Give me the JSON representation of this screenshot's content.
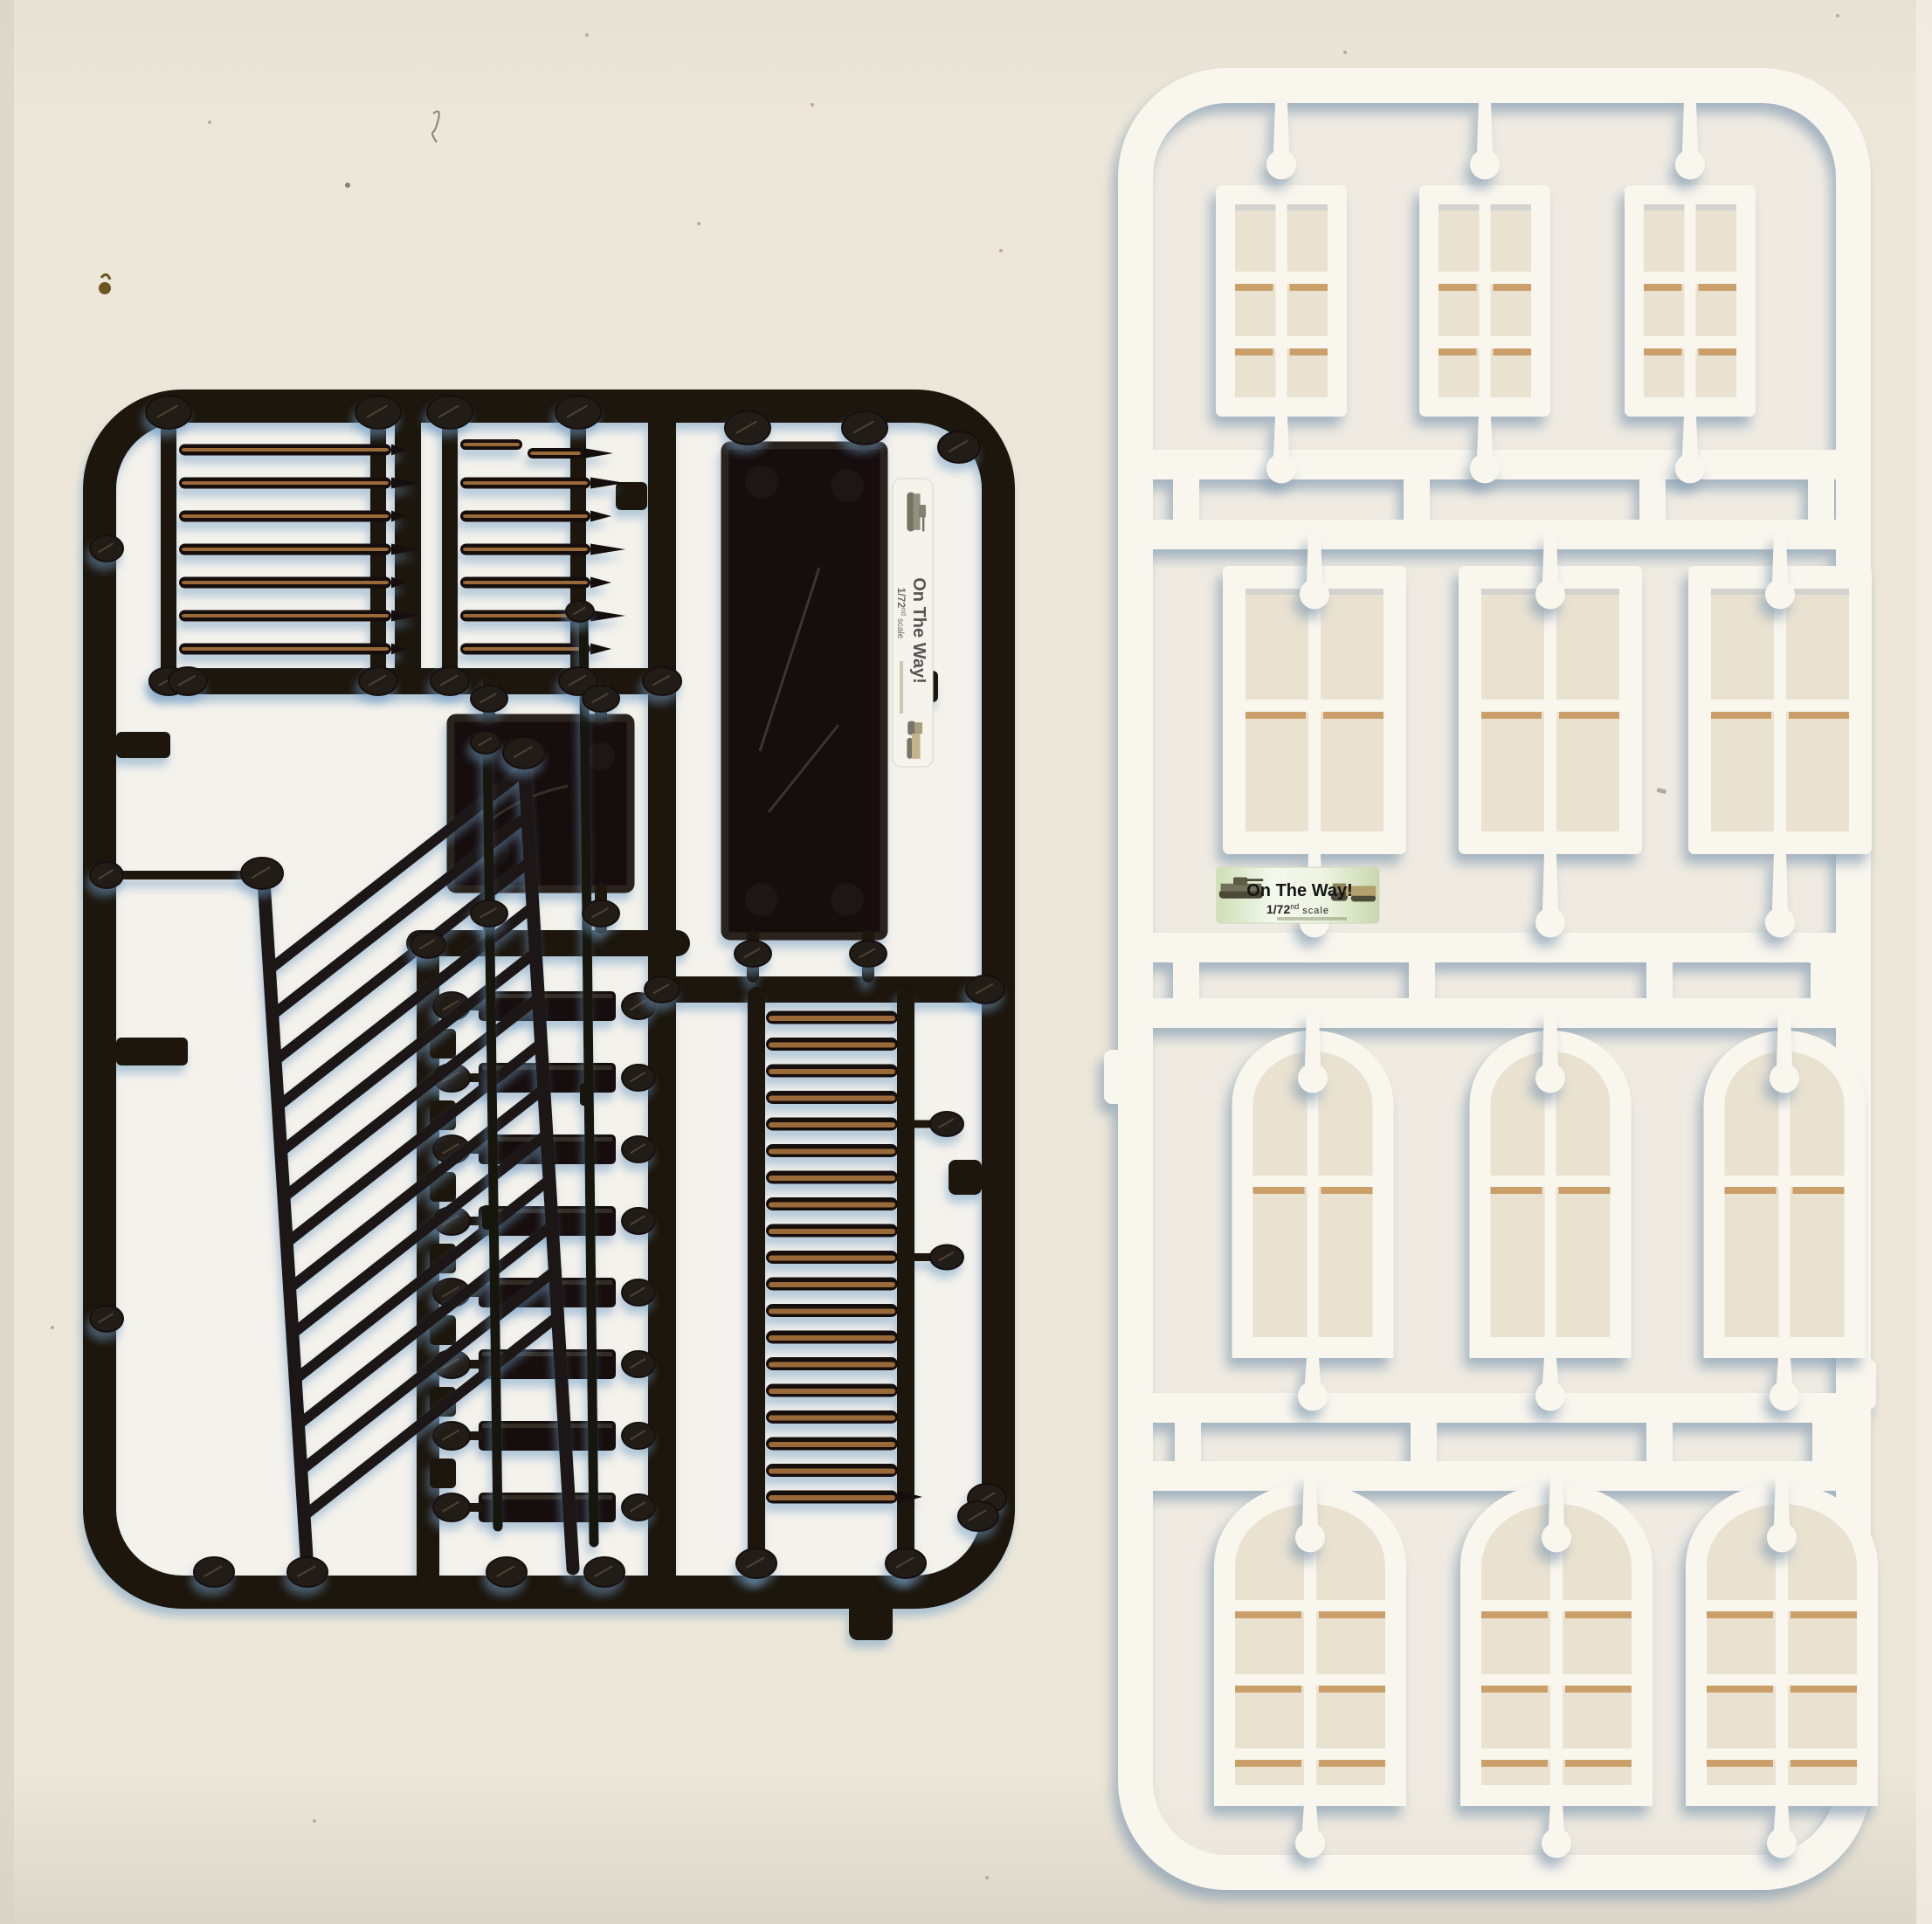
{
  "scene": {
    "description": "Flatbed scan of two injection-molded model kit sprues on a cream scanner bed",
    "background_hex": "#ebe5d7",
    "inner_backing_hex": "#f4f2ec"
  },
  "labels": {
    "brand": "On The Way!",
    "scale_num": "1/72",
    "scale_sup": "nd",
    "scale_word": "scale"
  },
  "black_sprue": {
    "name": "black detail sprue",
    "color_hex": "#1a1410",
    "parts": {
      "handrail_a_rungs": 7,
      "handrail_b_rungs": 7,
      "ladder_rungs": 19,
      "stair_treads": 8,
      "tread_tabs": 7,
      "balustrade_bars": 13,
      "rods": 2,
      "plates": [
        "large rectangular base plate",
        "square base plate"
      ]
    }
  },
  "white_sprue": {
    "name": "white window sprue",
    "color_hex": "#f9f6ee",
    "window_rows": [
      {
        "type": "six-pane sash window",
        "count": 3
      },
      {
        "type": "four-pane sash window",
        "count": 3
      },
      {
        "type": "arched four-pane window",
        "count": 3
      },
      {
        "type": "arched eight-pane window",
        "count": 3
      }
    ]
  },
  "colors": {
    "rung_amber": "#a0703a",
    "glazing_tan": "#c6985d",
    "shadow_blue": "#7fa0c0",
    "label_green": "#cde0b4"
  }
}
